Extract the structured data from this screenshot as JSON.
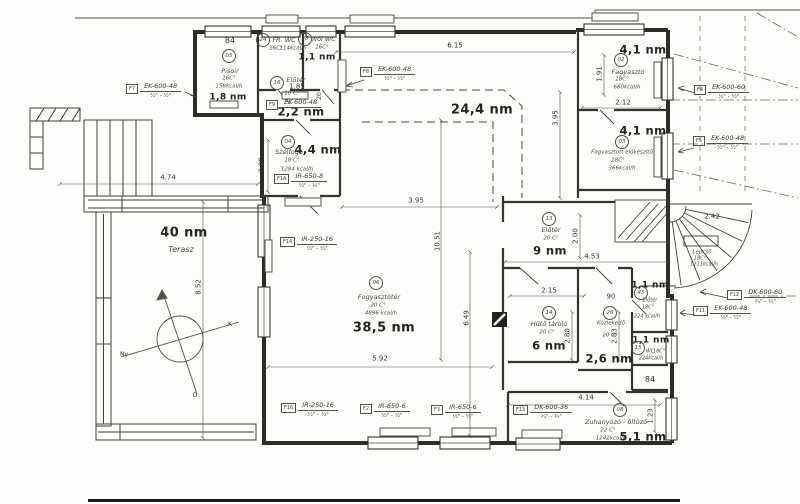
{
  "rooms": {
    "pisoir": {
      "num": "84",
      "code": "05",
      "name": "Pisoir",
      "temp": "16C°",
      "heat": "158kcal/h",
      "area": "1,8 nm"
    },
    "fr_wc": {
      "code": "24",
      "name": "FR. WC",
      "temp": "16C°",
      "heat": "114kcal/h"
    },
    "noi_wc": {
      "code": "28",
      "name": "Női WC",
      "temp": "16C°",
      "heat": "114kcal/h",
      "area": "1,1 nm"
    },
    "eloter_kis": {
      "code": "16",
      "name": "Előtér",
      "temp": "18 C°",
      "area": "2,2 nm"
    },
    "szelfogo": {
      "code": "04",
      "name": "Szélfogó",
      "temp": "18 C°",
      "heat": "1284 kcal/h",
      "area": "4,4 nm"
    },
    "fogyasztoter": {
      "code": "06",
      "name": "Fogyasztótér",
      "temp": "20 C°",
      "heat": "4896 kcal/h",
      "area": "38,5 nm"
    },
    "kulso_resz": {
      "area": "24,4 nm"
    },
    "terasz": {
      "area": "40 nm",
      "name": "Terasz"
    },
    "fagyaszto": {
      "code": "02",
      "name": "Fagyasztó",
      "temp": "18C°",
      "heat": "660kcal/h",
      "area": "4,1 nm"
    },
    "fagyasztott_elokeszito": {
      "code": "03",
      "name": "Fagyasztott előkészítő",
      "temp": "18C°",
      "heat": "366kcal/h",
      "area": "4,1 nm"
    },
    "eloter": {
      "code": "13",
      "name": "Előtér",
      "temp": "20 C°",
      "area": "9 nm"
    },
    "lepcso": {
      "name": "Lépcső",
      "temp": "18C°",
      "heat": "1211kcal/h"
    },
    "huto_tarolo": {
      "code": "14",
      "name": "Hűtő tároló",
      "temp": "20 C°",
      "area": "6 nm"
    },
    "kozlekedo": {
      "code": "26",
      "name": "Közlekedő",
      "temp": "20 C°",
      "area": "2,6 nm"
    },
    "eloter_11": {
      "code": "45",
      "name": "Előtér",
      "temp": "18C°",
      "heat": "224 kcal/h",
      "area": "1,1 nm"
    },
    "wc_11": {
      "code": "15",
      "name": "WC",
      "temp": "18C°",
      "heat": "224kcal/h",
      "area": "1,1 nm",
      "num": "84"
    },
    "zuhanyozo": {
      "code": "08",
      "name": "Zuhanyozó - öltöző",
      "temp": "22 C°",
      "heat": "1242kcal/h",
      "area": "5,1 nm"
    }
  },
  "radiators": {
    "f7": {
      "tag": "F7",
      "model": "EK-600-48",
      "size": "½\" - ½\""
    },
    "f8": {
      "tag": "F8",
      "model": "EK-600-48",
      "size": "½\" - ½\""
    },
    "f9": {
      "tag": "F9",
      "model": "EK-600-48",
      "size": "½\" - ½\""
    },
    "f1a": {
      "tag": "F1A",
      "model": "IR-650-8",
      "size": "½\" - ¾\""
    },
    "f14": {
      "tag": "F14",
      "model": "IR-250-16",
      "size": "½\" - ½\""
    },
    "f16": {
      "tag": "F16",
      "model": "IR-250-16",
      "size": "½\" - ½\""
    },
    "f2": {
      "tag": "F2",
      "model": "IR-650-6",
      "size": "½\" - ½\""
    },
    "f3": {
      "tag": "F3",
      "model": "IR-650-6",
      "size": "½\" - ½\""
    },
    "f13": {
      "tag": "F13",
      "model": "DK-600-36",
      "size": "¾\" - ¾\""
    },
    "f4": {
      "tag": "F4",
      "model": "EK-600-60",
      "size": "½\" - ½\""
    },
    "f5": {
      "tag": "F5",
      "model": "EK-600-48",
      "size": "½\" - ½\""
    },
    "f12": {
      "tag": "F12",
      "model": "DK-600-60",
      "size": "¾\" - ¾\""
    },
    "f11": {
      "tag": "F11",
      "model": "EK-600-48",
      "size": "½\" - ½\""
    }
  },
  "dims": {
    "d615": "6.15",
    "d395a": "3.95",
    "d395b": "3.95",
    "d1051": "10.51",
    "d649": "6.49",
    "d592": "5.92",
    "d474": "4.74",
    "d852": "8.52",
    "d200a": "2.00",
    "d185": "1.85",
    "d20": "20",
    "d191": "1.91",
    "d212": "2.12",
    "d242": "2.42",
    "d200b": "2.00",
    "d453": "4.53",
    "d215": "2.15",
    "d90": "90",
    "d280": "2.80",
    "d283": "2.83",
    "d414": "4.14",
    "d123": "1.23"
  },
  "compass": {
    "east": "K",
    "west": "Ny",
    "south": "D"
  }
}
